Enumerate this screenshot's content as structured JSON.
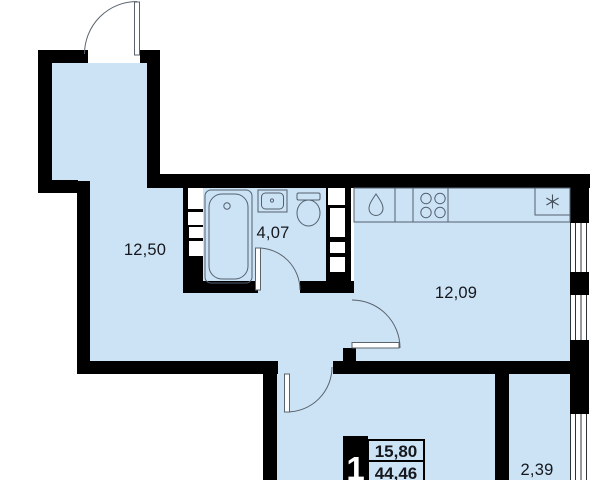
{
  "colors": {
    "room_fill": "#cce3f6",
    "wall": "#000000",
    "text": "#15171c",
    "outline": "#53616e",
    "window_line": "#2e3338",
    "door": "#59636d"
  },
  "rooms": {
    "hallway": {
      "area": "12,50"
    },
    "bathroom": {
      "area": "4,07"
    },
    "kitchen": {
      "area": "12,09"
    },
    "balcony": {
      "area": "2,39"
    }
  },
  "badge": {
    "room_count": "1",
    "living_area": "15,80",
    "total_area": "44,46"
  },
  "fixtures": [
    "bathtub",
    "washbasin",
    "toilet",
    "kitchen-sink",
    "stove",
    "fridge",
    "entry-door",
    "bathroom-door",
    "kitchen-door",
    "living-room-door",
    "windows"
  ]
}
